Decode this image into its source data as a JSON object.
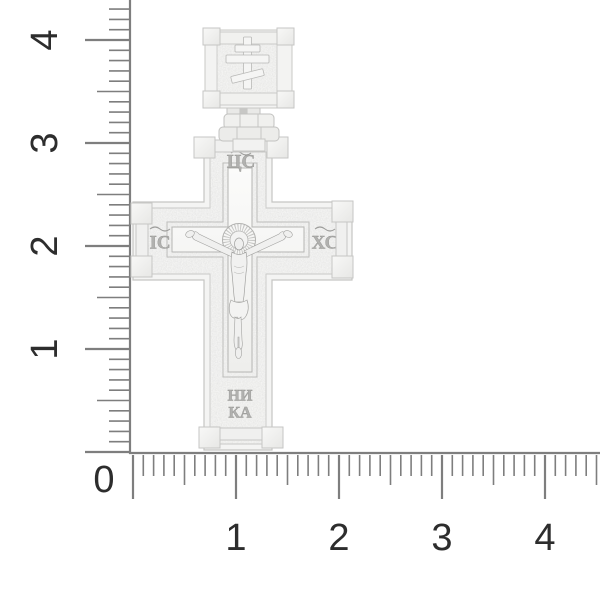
{
  "meta": {
    "description": "Product photo of a silver Orthodox crucifix cross pendant on a white background, with centimeter rulers along the left and bottom edges"
  },
  "pendant": {
    "kind": "orthodox-crucifix-cross-pendant",
    "inscriptions": {
      "top": "ЦС",
      "left": "ІС",
      "right": "ХС",
      "bottom_line1": "НИ",
      "bottom_line2": "КА"
    },
    "colors": {
      "metal_highlight": "#f8f8f7",
      "metal_base": "#f2f2f1",
      "metal_texture": "#ebebe9",
      "metal_edge": "#c6c6c4",
      "engraving": "#a5a5a3"
    }
  },
  "rulers": {
    "origin_label": "0",
    "vertical": {
      "labels": [
        "1",
        "2",
        "3",
        "4"
      ]
    },
    "horizontal": {
      "labels": [
        "1",
        "2",
        "3",
        "4"
      ]
    },
    "tick_color": "#7e7e7e",
    "label_color": "#2d2d2d"
  }
}
